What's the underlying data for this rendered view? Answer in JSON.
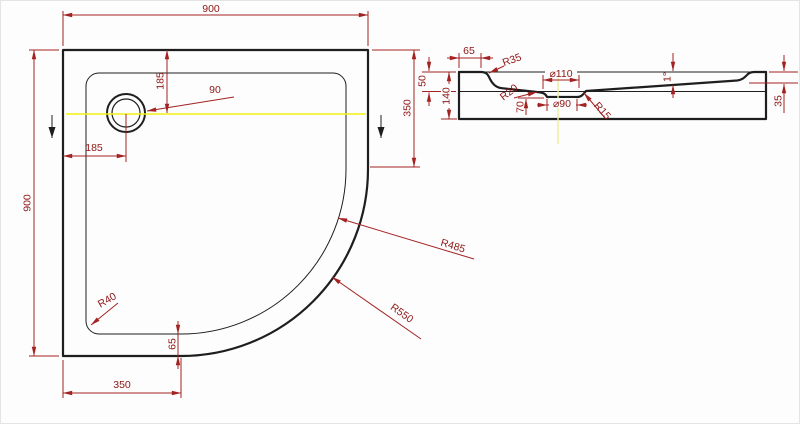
{
  "colors": {
    "outline": "#1e1e1e",
    "dimension_lines": "#a32222",
    "dimension_text": "#8f1616",
    "centerline": "#f1f113",
    "background": "#fdfdfd"
  },
  "plan": {
    "width_top": "900",
    "height_left": "900",
    "drain_from_top": "185",
    "drain_from_left": "185",
    "drain_diameter": "90",
    "inner_corner_radius": "R40",
    "rim_offset": "65",
    "bottom_straight": "350",
    "right_straight": "350",
    "inner_arc_radius": "R485",
    "outer_arc_radius": "R550"
  },
  "section": {
    "flange_width": "65",
    "flange_radius": "R35",
    "front_depth": "50",
    "total_height": "140",
    "waste_top_diameter": "⌀110",
    "waste_bottom_diameter": "⌀90",
    "waste_left_radius": "R20",
    "waste_depth": "70",
    "waste_right_radius": "R15",
    "floor_slope": "1°",
    "back_depth": "35"
  }
}
